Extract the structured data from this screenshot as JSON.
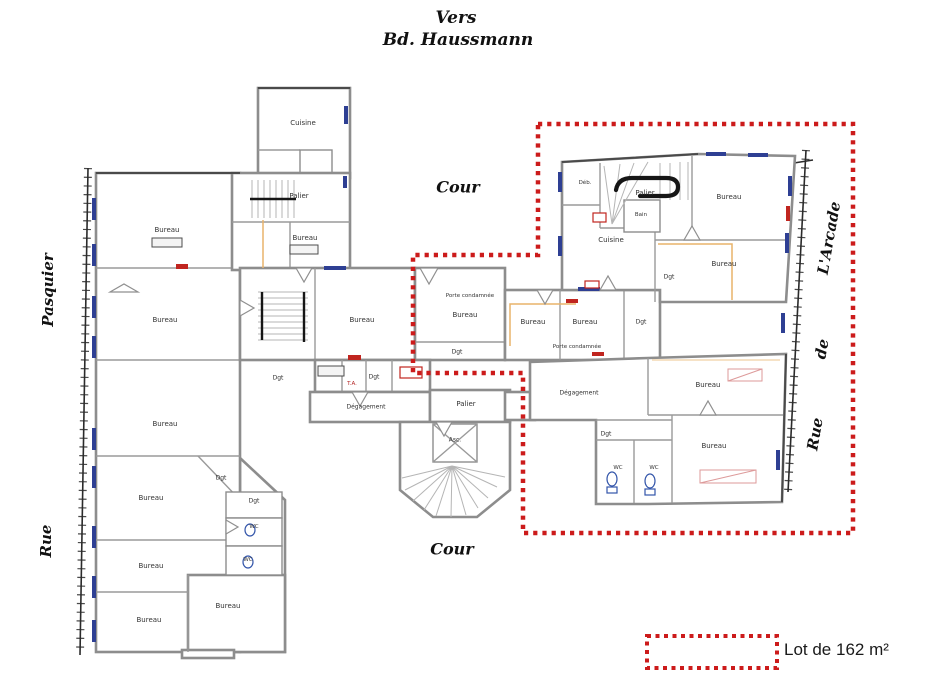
{
  "street_labels": {
    "vers_line1": "Vers",
    "vers_line2": "Bd. Haussmann",
    "cour_top": "Cour",
    "cour_bottom": "Cour",
    "pasquier": "Pasquier",
    "rue_left": "Rue",
    "arcade": "L'Arcade",
    "de": "de",
    "rue_right": "Rue"
  },
  "legend": {
    "lot_label": "Lot de 162 m²"
  },
  "colors": {
    "lot": "#cc1b1b",
    "win": "#2e3f93",
    "red": "#c0251f",
    "orange": "#e8b36a",
    "wall": "#8d8d8d"
  },
  "rooms": [
    {
      "label": "Cuisine",
      "x": 303,
      "y": 123
    },
    {
      "label": "Palier",
      "x": 299,
      "y": 196
    },
    {
      "label": "Bureau",
      "x": 167,
      "y": 230
    },
    {
      "label": "Bureau",
      "x": 305,
      "y": 238
    },
    {
      "label": "Bureau",
      "x": 165,
      "y": 320
    },
    {
      "label": "Bureau",
      "x": 362,
      "y": 320
    },
    {
      "label": "Porte condamnée",
      "x": 470,
      "y": 296,
      "fs": 5.5
    },
    {
      "label": "Bureau",
      "x": 465,
      "y": 315
    },
    {
      "label": "Bureau",
      "x": 533,
      "y": 322
    },
    {
      "label": "Bureau",
      "x": 585,
      "y": 322
    },
    {
      "label": "Porte condamnée",
      "x": 577,
      "y": 347,
      "fs": 5.5
    },
    {
      "label": "Dgt",
      "x": 641,
      "y": 322,
      "fs": 6
    },
    {
      "label": "Dgt",
      "x": 278,
      "y": 378,
      "fs": 6
    },
    {
      "label": "T.A.",
      "x": 352,
      "y": 384,
      "fs": 5.5,
      "color": "#b22222"
    },
    {
      "label": "Dgt",
      "x": 374,
      "y": 377,
      "fs": 6
    },
    {
      "label": "Dégagement",
      "x": 366,
      "y": 407,
      "fs": 6
    },
    {
      "label": "Palier",
      "x": 466,
      "y": 404
    },
    {
      "label": "Asc.",
      "x": 455,
      "y": 440,
      "fs": 6
    },
    {
      "label": "Dgt",
      "x": 457,
      "y": 352,
      "fs": 6
    },
    {
      "label": "Déb.",
      "x": 585,
      "y": 183,
      "fs": 5.5
    },
    {
      "label": "Palier",
      "x": 645,
      "y": 193
    },
    {
      "label": "Bain",
      "x": 641,
      "y": 215,
      "fs": 5.5
    },
    {
      "label": "Cuisine",
      "x": 611,
      "y": 240
    },
    {
      "label": "Bureau",
      "x": 729,
      "y": 197
    },
    {
      "label": "Bureau",
      "x": 724,
      "y": 264
    },
    {
      "label": "Dgt",
      "x": 669,
      "y": 277,
      "fs": 6
    },
    {
      "label": "Dégagement",
      "x": 579,
      "y": 393,
      "fs": 6
    },
    {
      "label": "Bureau",
      "x": 708,
      "y": 385
    },
    {
      "label": "Bureau",
      "x": 714,
      "y": 446
    },
    {
      "label": "Dgt",
      "x": 606,
      "y": 434,
      "fs": 6
    },
    {
      "label": "WC",
      "x": 618,
      "y": 468,
      "fs": 5.5
    },
    {
      "label": "WC",
      "x": 654,
      "y": 468,
      "fs": 5.5
    },
    {
      "label": "Bureau",
      "x": 165,
      "y": 424
    },
    {
      "label": "Dgt",
      "x": 221,
      "y": 478,
      "fs": 6
    },
    {
      "label": "Bureau",
      "x": 151,
      "y": 498
    },
    {
      "label": "Dgt",
      "x": 254,
      "y": 501,
      "fs": 6
    },
    {
      "label": "WC",
      "x": 254,
      "y": 527,
      "fs": 5.5
    },
    {
      "label": "WC",
      "x": 248,
      "y": 560,
      "fs": 5.5
    },
    {
      "label": "Bureau",
      "x": 151,
      "y": 566
    },
    {
      "label": "Bureau",
      "x": 228,
      "y": 606
    },
    {
      "label": "Bureau",
      "x": 149,
      "y": 620
    }
  ]
}
